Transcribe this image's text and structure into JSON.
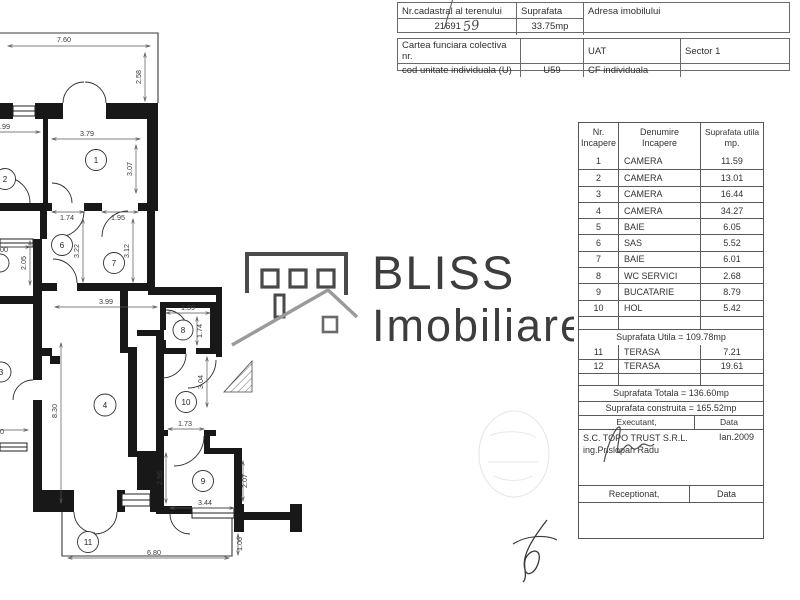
{
  "document": {
    "cadastral": {
      "nr_cadastral_label": "Nr.cadastral al terenului",
      "nr_cadastral_value": "21691",
      "nr_cadastral_handwritten": "59",
      "suprafata_label": "Suprafata",
      "suprafata_value": "33.75mp",
      "adresa_label": "Adresa imobilului",
      "cartea_label": "Cartea funciara colectiva nr.",
      "cod_label": "cod unitate individuala (U)",
      "cod_value": "U59",
      "uat_label": "UAT",
      "uat_value": "Sector 1",
      "cf_label": "CF individuala"
    },
    "logo": {
      "name": "BLISS",
      "tagline": "Imobiliare"
    },
    "room_table": {
      "header": {
        "col1a": "Nr.",
        "col1b": "Incapere",
        "col2a": "Denumire",
        "col2b": "Incapere",
        "col3a": "Suprafata utila",
        "col3b": "mp."
      },
      "rows": [
        {
          "nr": "1",
          "name": "CAMERA",
          "area": "11.59"
        },
        {
          "nr": "2",
          "name": "CAMERA",
          "area": "13.01"
        },
        {
          "nr": "3",
          "name": "CAMERA",
          "area": "16.44"
        },
        {
          "nr": "4",
          "name": "CAMERA",
          "area": "34.27"
        },
        {
          "nr": "5",
          "name": "BAIE",
          "area": "6.05"
        },
        {
          "nr": "6",
          "name": "SAS",
          "area": "5.52"
        },
        {
          "nr": "7",
          "name": "BAIE",
          "area": "6.01"
        },
        {
          "nr": "8",
          "name": "WC SERVICI",
          "area": "2.68"
        },
        {
          "nr": "9",
          "name": "BUCATARIE",
          "area": "8.79"
        },
        {
          "nr": "10",
          "name": "HOL",
          "area": "5.42"
        }
      ],
      "suprafata_utila": "Suprafata Utila = 109.78mp",
      "terase": [
        {
          "nr": "11",
          "name": "TERASA",
          "area": "7.21"
        },
        {
          "nr": "12",
          "name": "TERASA",
          "area": "19.61"
        }
      ],
      "suprafata_totala": "Suprafata Totala = 136.60mp",
      "suprafata_construita": "Suprafata construita = 165.52mp",
      "executant_label": "Executant,",
      "executant_data_label": "Data",
      "executant_company": "S.C. TOPO TRUST S.R.L.",
      "executant_engineer": "ing.Prislopan Radu",
      "executant_date": "Ian.2009",
      "receptionat_label": "Receptionat,",
      "receptionat_data_label": "Data"
    },
    "plan": {
      "rooms": {
        "r1": "1",
        "r2": "2",
        "r3": "3",
        "r4": "4",
        "r6": "6",
        "r7": "7",
        "r8": "8",
        "r9": "9",
        "r10": "10",
        "r11": "11"
      },
      "dims": {
        "d760": "7.60",
        "d258": "2.58",
        "d379": "3.79",
        "d307": "3.07",
        "d99": ".99",
        "d174a": "1.74",
        "d195": "1.95",
        "d200": "00",
        "d205": "2.05",
        "d322": "3.22",
        "d312": "3.12",
        "d399": "3.99",
        "d159": "1.59",
        "d174b": "1.74",
        "d304": "3.04",
        "d830": "8.30",
        "d173": "1.73",
        "d296": "2.96",
        "d207": "2.07",
        "d344": "3.44",
        "d680": "6.80",
        "d106": "1.06",
        "d0": "0"
      }
    }
  }
}
